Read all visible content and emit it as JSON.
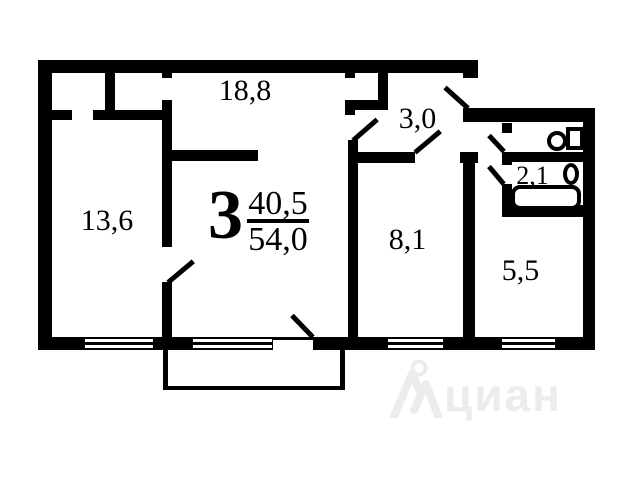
{
  "plan": {
    "designation": {
      "rooms_count": "3",
      "living_area": "40,5",
      "total_area": "54,0"
    },
    "rooms": [
      {
        "key": "living-room",
        "area_label": "18,8"
      },
      {
        "key": "hallway",
        "area_label": "3,0"
      },
      {
        "key": "bedroom-left",
        "area_label": "13,6"
      },
      {
        "key": "bedroom-right",
        "area_label": "8,1"
      },
      {
        "key": "kitchen",
        "area_label": "5,5"
      },
      {
        "key": "bathroom",
        "area_label": "2,1"
      }
    ],
    "fixtures": [
      "toilet",
      "sink",
      "bathtub"
    ],
    "colors": {
      "wall": "#000000",
      "background": "#ffffff",
      "watermark": "#ececec"
    },
    "watermark": {
      "text": "циан"
    }
  }
}
